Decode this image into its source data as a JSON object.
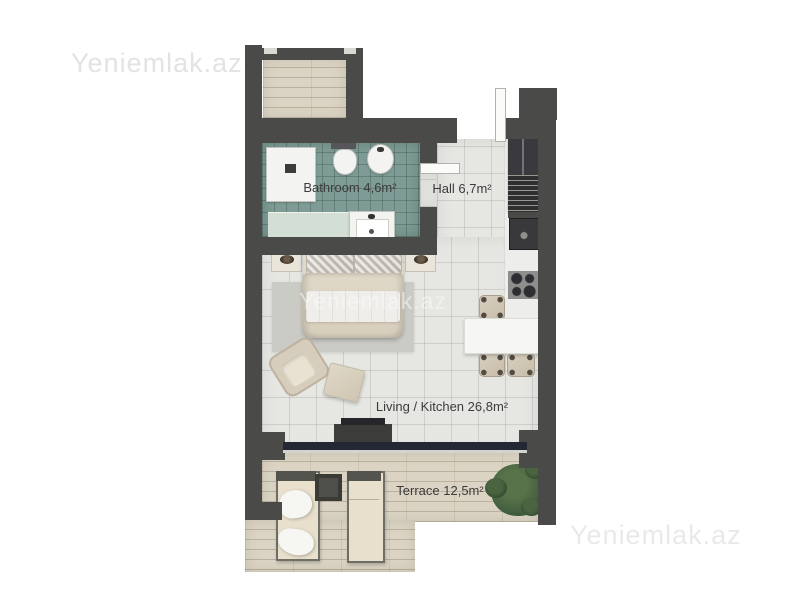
{
  "watermarks": {
    "top_left": "Yeniemlak.az",
    "center": "Yeniemlak.az",
    "bottom_right": "Yeniemlak.az"
  },
  "floorplan": {
    "rooms": [
      {
        "id": "bathroom",
        "label": "Bathroom 4,6m²"
      },
      {
        "id": "hall",
        "label": "Hall 6,7m²"
      },
      {
        "id": "living_kitchen",
        "label": "Living / Kitchen 26,8m²"
      },
      {
        "id": "terrace",
        "label": "Terrace 12,5m²"
      }
    ],
    "furniture": [
      "double-bed",
      "nightstand-left",
      "nightstand-right",
      "rug",
      "armchair",
      "ottoman",
      "tv-unit",
      "dining-table",
      "chair",
      "chair",
      "chair",
      "fridge",
      "laundry-unit",
      "oven",
      "cooktop",
      "shower",
      "toilet",
      "bidet",
      "washbasin",
      "vanity-counter",
      "entry-door",
      "bathroom-door",
      "sun-lounger",
      "sun-lounger",
      "side-table",
      "plant",
      "upper-balcony"
    ],
    "colors": {
      "wall": "#4a4a48",
      "bathroom_tile": "#7e9c95",
      "floor_tile": "#e6e7e3",
      "wood": "#dbd4c4",
      "window": "#232834",
      "plant": "#3e5a3c",
      "label_text": "#3b3b3b",
      "watermark": "#e3e3e3"
    }
  }
}
